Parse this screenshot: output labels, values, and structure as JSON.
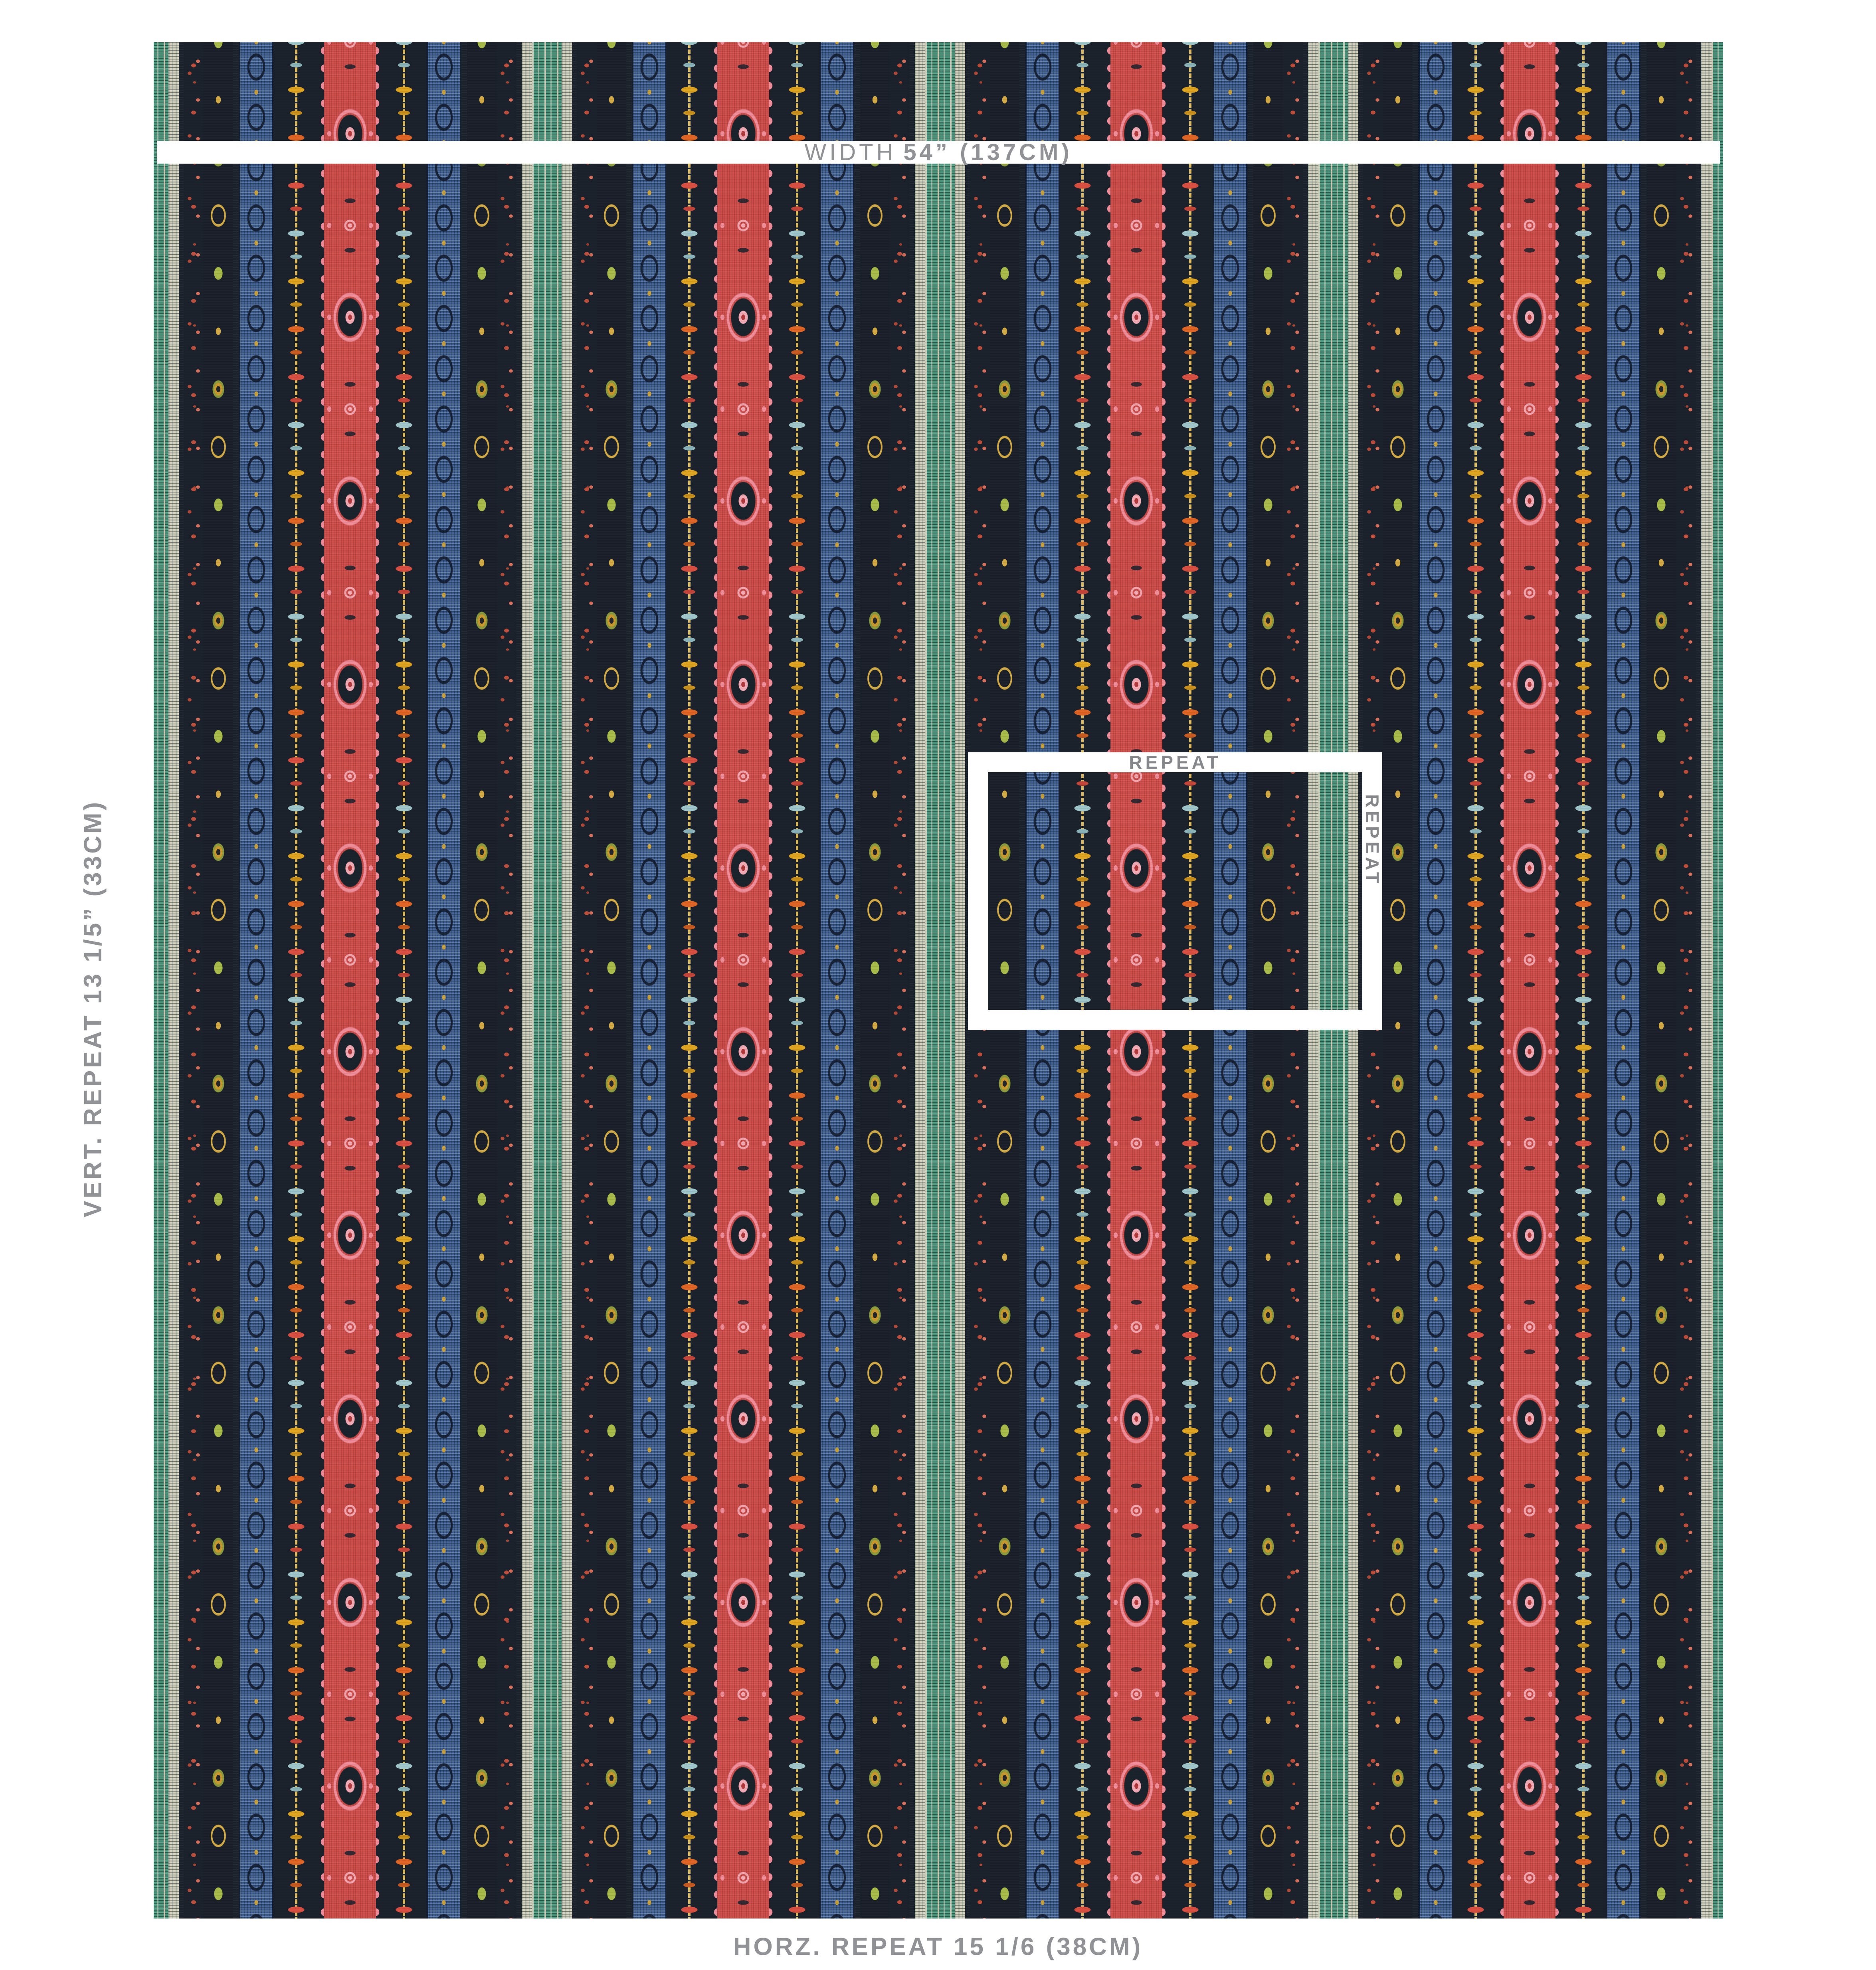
{
  "diagram": {
    "description": "Multicolor embroidered ikat stripe fabric swatch with measurement annotations",
    "labels": {
      "width_word": "WIDTH",
      "width_value": "54” (137CM)",
      "vertical_repeat": "VERT. REPEAT 13 1/5” (33CM)",
      "horizontal_repeat": "HORZ. REPEAT 15 1/6 (38CM)",
      "repeat_box_top": "REPEAT",
      "repeat_box_right": "REPEAT"
    },
    "label_color": "#909295",
    "repeat_box_label_color": "#85878a",
    "overlay_color": "#ffffff"
  },
  "fabric": {
    "ground_color": "#1b222c",
    "stripe_sequence": [
      "teal-cream plaid band",
      "rust dot-cluster column",
      "gold-olive diamond medallion column",
      "blue ikat band",
      "floral sprig column (orange/coral/light-blue/gold blooms on yellow dashed stem)",
      "red medallion band with pink scalloped edges",
      "floral sprig column",
      "blue ikat band",
      "diamond medallion column",
      "rust dot-cluster column"
    ],
    "repeat_columns_visible": 4,
    "palette": {
      "ground": "#1b222c",
      "teal": "#47947b",
      "teal_light": "#7fbfa9",
      "cream": "#d6d3c0",
      "red": "#d04c49",
      "red_deep": "#b23a3c",
      "pink": "#ef8e9a",
      "pink_light": "#f3abb5",
      "blue": "#3f5f92",
      "blue_light": "#86a8d0",
      "gold": "#c9992e",
      "olive": "#8b9b3d",
      "lime": "#a9bc4a",
      "rust": "#bf4f3a",
      "coral": "#d9705b",
      "coral_red": "#d94f42",
      "orange": "#e06423",
      "light_blue": "#9fc7cb",
      "marigold": "#dea31f",
      "stem": "#ddbb63",
      "label": "#909295",
      "repeat_label": "#85878a"
    }
  }
}
